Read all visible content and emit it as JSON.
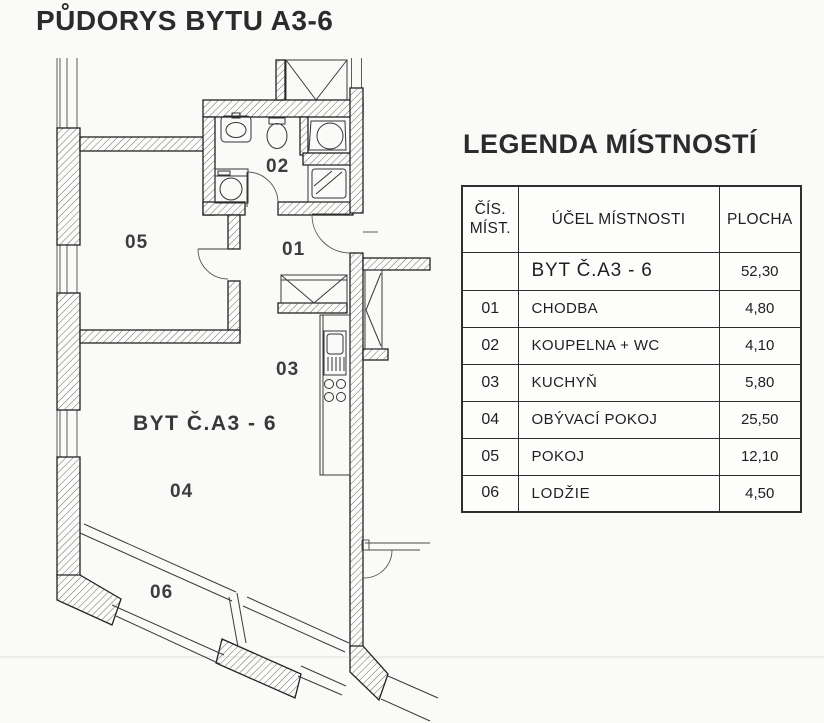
{
  "page": {
    "title": "PŮDORYS BYTU A3-6"
  },
  "legend": {
    "title": "LEGENDA MÍSTNOSTÍ",
    "headers": {
      "col1_line1": "ČÍS.",
      "col1_line2": "MÍST.",
      "col2": "ÚČEL MÍSTNOSTI",
      "col3": "PLOCHA"
    },
    "summary": {
      "name": "BYT Č.A3 - 6",
      "area": "52,30"
    },
    "rows": [
      {
        "num": "01",
        "name": "CHODBA",
        "area": "4,80"
      },
      {
        "num": "02",
        "name": "KOUPELNA + WC",
        "area": "4,10"
      },
      {
        "num": "03",
        "name": "KUCHYŇ",
        "area": "5,80"
      },
      {
        "num": "04",
        "name": "OBÝVACÍ POKOJ",
        "area": "25,50"
      },
      {
        "num": "05",
        "name": "POKOJ",
        "area": "12,10"
      },
      {
        "num": "06",
        "name": "LODŽIE",
        "area": "4,50"
      }
    ]
  },
  "floorplan": {
    "apartment_label": "BYT Č.A3 - 6",
    "room_numbers": {
      "r01": "01",
      "r02": "02",
      "r03": "03",
      "r04": "04",
      "r05": "05",
      "r06": "06"
    }
  }
}
